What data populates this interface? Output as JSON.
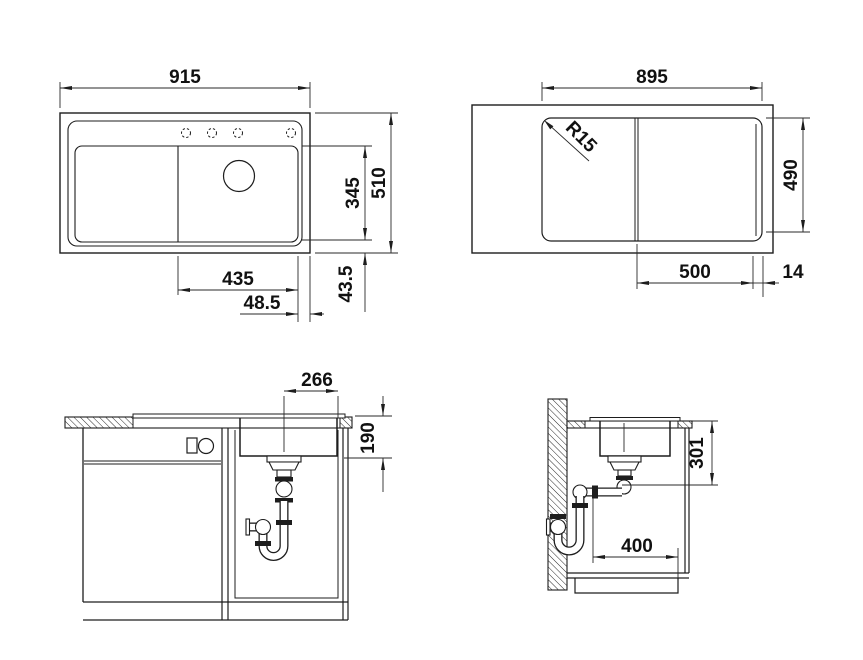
{
  "drawing": {
    "background": "#ffffff",
    "line_color": "#1d1d1d",
    "views": {
      "top_view": {
        "dims": {
          "overall_width": "915",
          "overall_depth": "510",
          "bowl_depth": "345",
          "bowl_width": "435",
          "bowl_side_offset": "48.5",
          "bowl_front_offset": "43.5"
        }
      },
      "cutout_view": {
        "dims": {
          "cutout_width": "895",
          "cutout_depth": "490",
          "bowl_zone_width": "500",
          "edge_distance": "14",
          "corner_radius": "R15"
        }
      },
      "front_section": {
        "dims": {
          "drain_to_edge": "266",
          "bowl_inner_depth": "190"
        }
      },
      "side_section": {
        "dims": {
          "total_depth": "301",
          "base_clearance": "400"
        }
      }
    }
  }
}
